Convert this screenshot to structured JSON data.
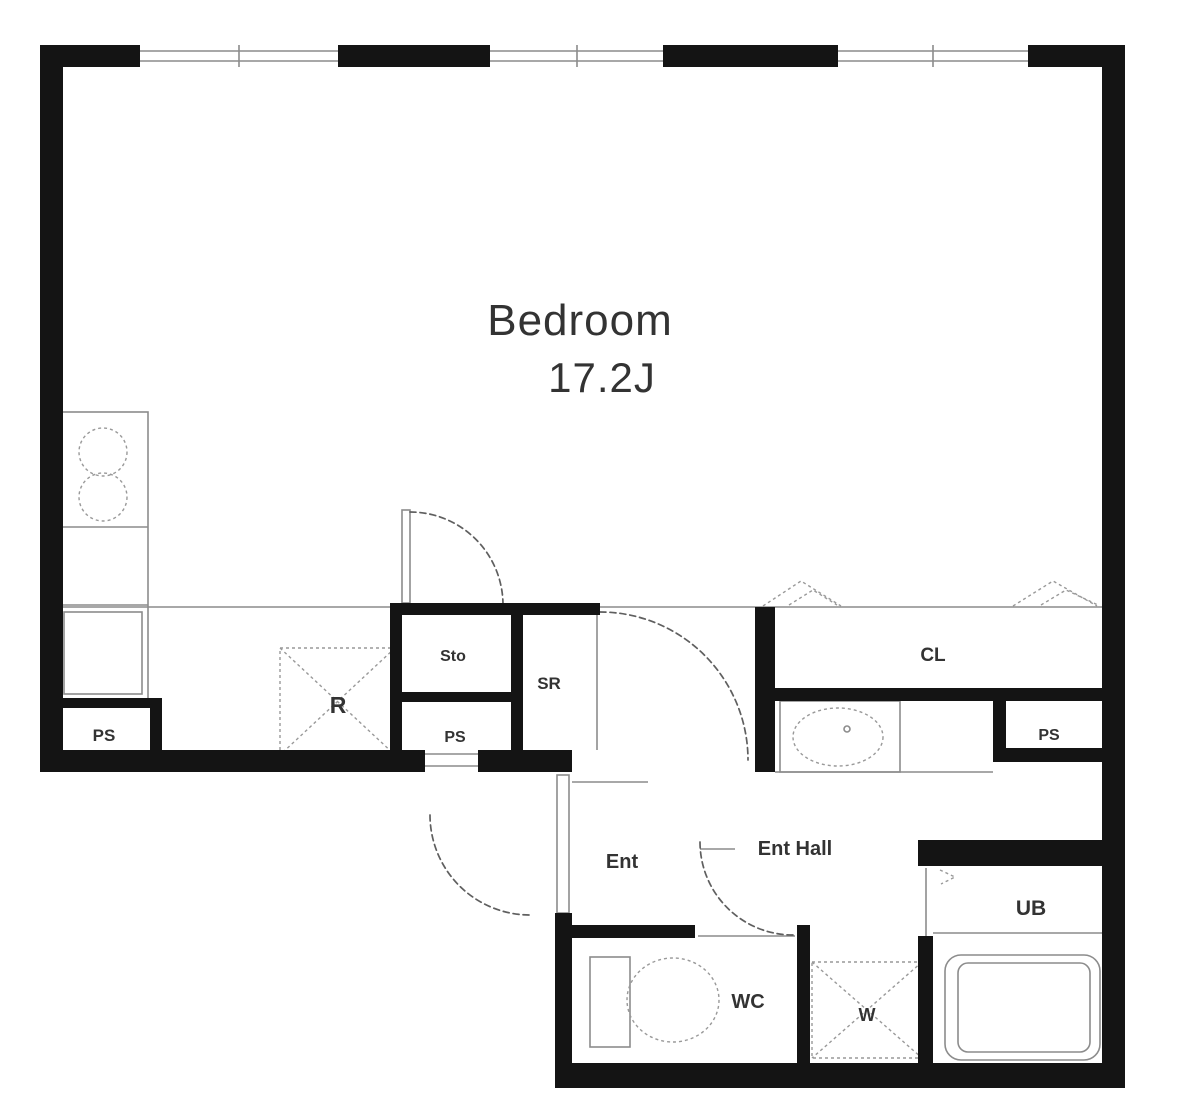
{
  "plan": {
    "rooms": {
      "bedroom": {
        "name": "Bedroom",
        "size": "17.2J"
      },
      "closet": "CL",
      "service_room": "SR",
      "storage": "Sto",
      "entrance": "Ent",
      "entrance_hall": "Ent Hall",
      "unit_bath": "UB",
      "toilet": "WC"
    },
    "fixtures": {
      "refrigerator": "R",
      "washer": "W",
      "pipe_space_left": "PS",
      "pipe_space_mid": "PS",
      "pipe_space_right": "PS"
    },
    "colors": {
      "wall": "#141414",
      "thin_line": "#8c8c8c",
      "dashed_line": "#5f5f5f",
      "fixture_line": "#999999",
      "label": "#333333"
    }
  }
}
